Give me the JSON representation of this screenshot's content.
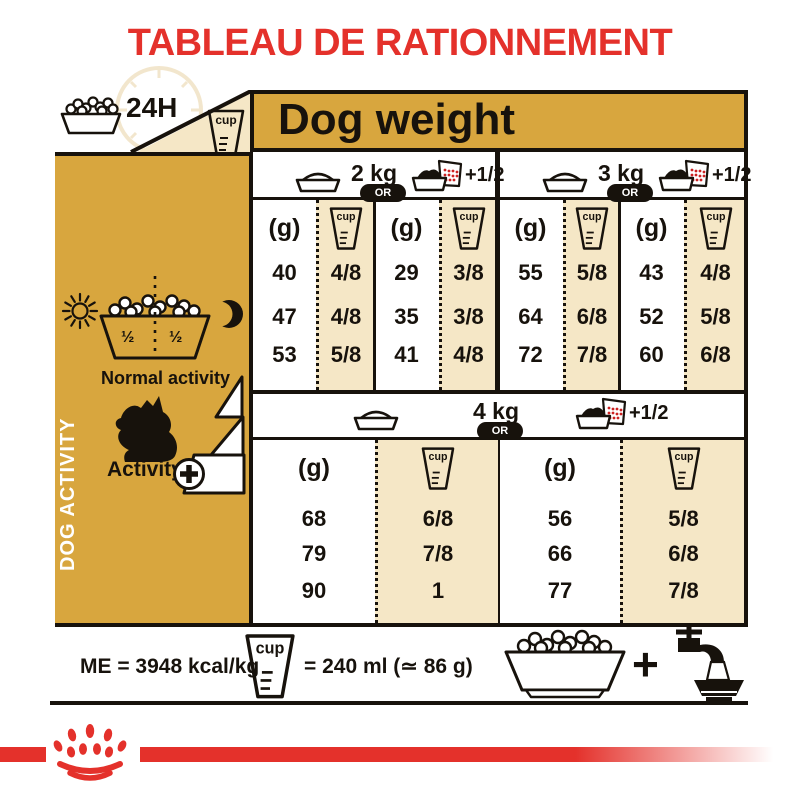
{
  "title": "TABLEAU DE RATIONNEMENT",
  "header": {
    "hours_label": "24H",
    "cup_label": "cup",
    "dog_weight_label": "Dog weight"
  },
  "sidebar": {
    "vertical_label": "DOG ACTIVITY",
    "bowl_half_left": "½",
    "bowl_half_right": "½",
    "normal_activity_label": "Normal activity",
    "activity_label": "Activity"
  },
  "table": {
    "gram_header": "(g)",
    "cup_header": "cup",
    "or_label": "OR",
    "plus_half_label": "+1/2",
    "sections": [
      {
        "weight": "2 kg",
        "pairs": [
          {
            "g": [
              "40",
              "47",
              "53"
            ],
            "cup": [
              "4/8",
              "4/8",
              "5/8"
            ]
          },
          {
            "g": [
              "29",
              "35",
              "41"
            ],
            "cup": [
              "3/8",
              "3/8",
              "4/8"
            ]
          }
        ]
      },
      {
        "weight": "3 kg",
        "pairs": [
          {
            "g": [
              "55",
              "64",
              "72"
            ],
            "cup": [
              "5/8",
              "6/8",
              "7/8"
            ]
          },
          {
            "g": [
              "43",
              "52",
              "60"
            ],
            "cup": [
              "4/8",
              "5/8",
              "6/8"
            ]
          }
        ]
      },
      {
        "weight": "4 kg",
        "pairs": [
          {
            "g": [
              "68",
              "79",
              "90"
            ],
            "cup": [
              "6/8",
              "7/8",
              "1"
            ]
          },
          {
            "g": [
              "56",
              "66",
              "77"
            ],
            "cup": [
              "5/8",
              "6/8",
              "7/8"
            ]
          }
        ]
      }
    ]
  },
  "footer": {
    "me_label": "ME = 3948 kcal/kg",
    "cup_label": "cup",
    "cup_equivalence": "= 240 ml (≃ 86 g)",
    "plus": "+"
  },
  "colors": {
    "brand_red": "#e4312b",
    "gold": "#d8a63e",
    "cream": "#f5e7c6",
    "ink_black": "#17120c"
  }
}
